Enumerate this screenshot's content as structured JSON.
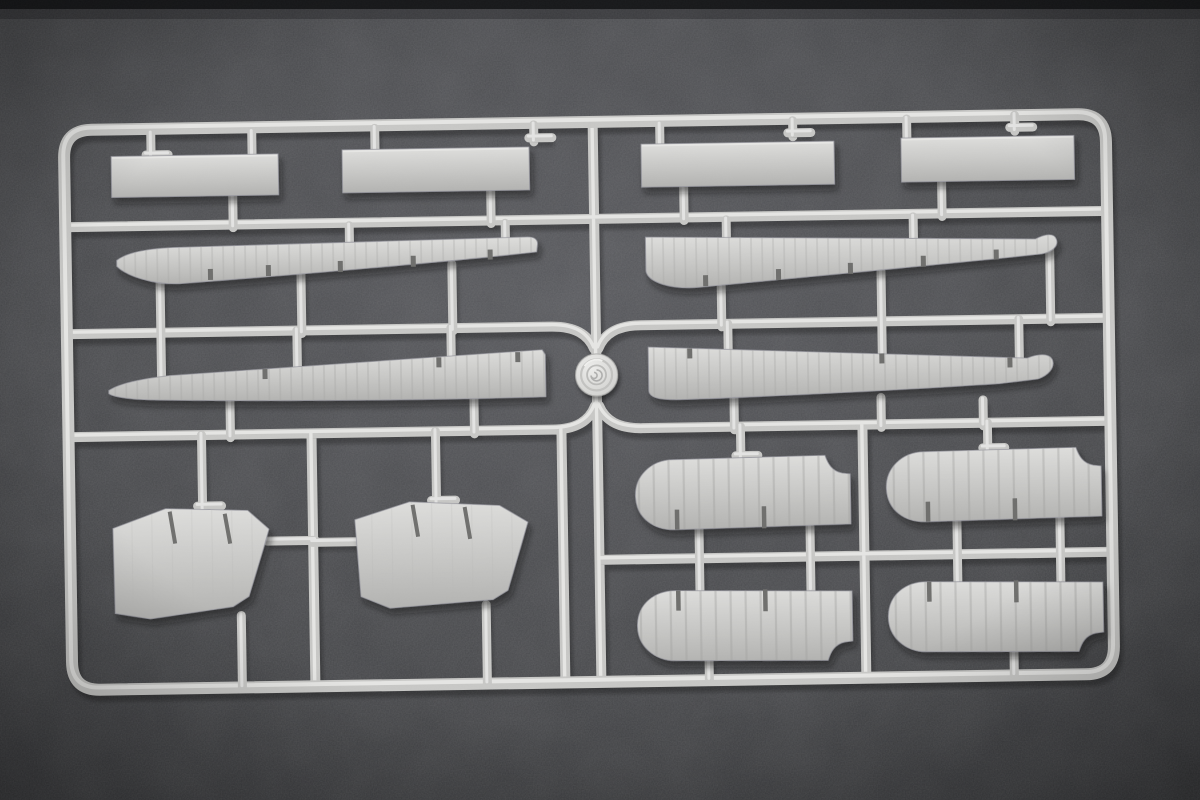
{
  "image": {
    "kind": "photograph",
    "subject": "injection-molded plastic model kit sprue with aircraft wing and stabilizer parts",
    "background": "dark speckled grey surface",
    "visible_text": ""
  },
  "colors": {
    "bg_center": "#57585c",
    "bg_mid": "#46474a",
    "bg_edge": "#343537",
    "top_strip": "#17181a",
    "plastic_light": "#e8e8e6",
    "plastic_base": "#c7c7c5",
    "plastic_top": "#dddddb",
    "plastic_mid": "#c6c6c4",
    "plastic_dark": "#b2b2b0",
    "plastic_outline": "#97979f",
    "rib_line": "#a4a4a2",
    "notch": "#6e6e6c",
    "shadow": "#0d0d0f",
    "medallion_light": "#ececea",
    "medallion_base": "#cfcfcd"
  },
  "sprue": {
    "frame": "rounded rectangular runner frame",
    "medallion": "embossed circular maker medallion at centre of runner network",
    "parts": [
      {
        "name": "narrow strip panel",
        "count": 4
      },
      {
        "name": "long tapered wing panel",
        "count": 4
      },
      {
        "name": "angled trapezoid panel",
        "count": 2
      },
      {
        "name": "rounded stabilizer panel with rib detail",
        "count": 4
      }
    ],
    "parts_total": 14
  }
}
